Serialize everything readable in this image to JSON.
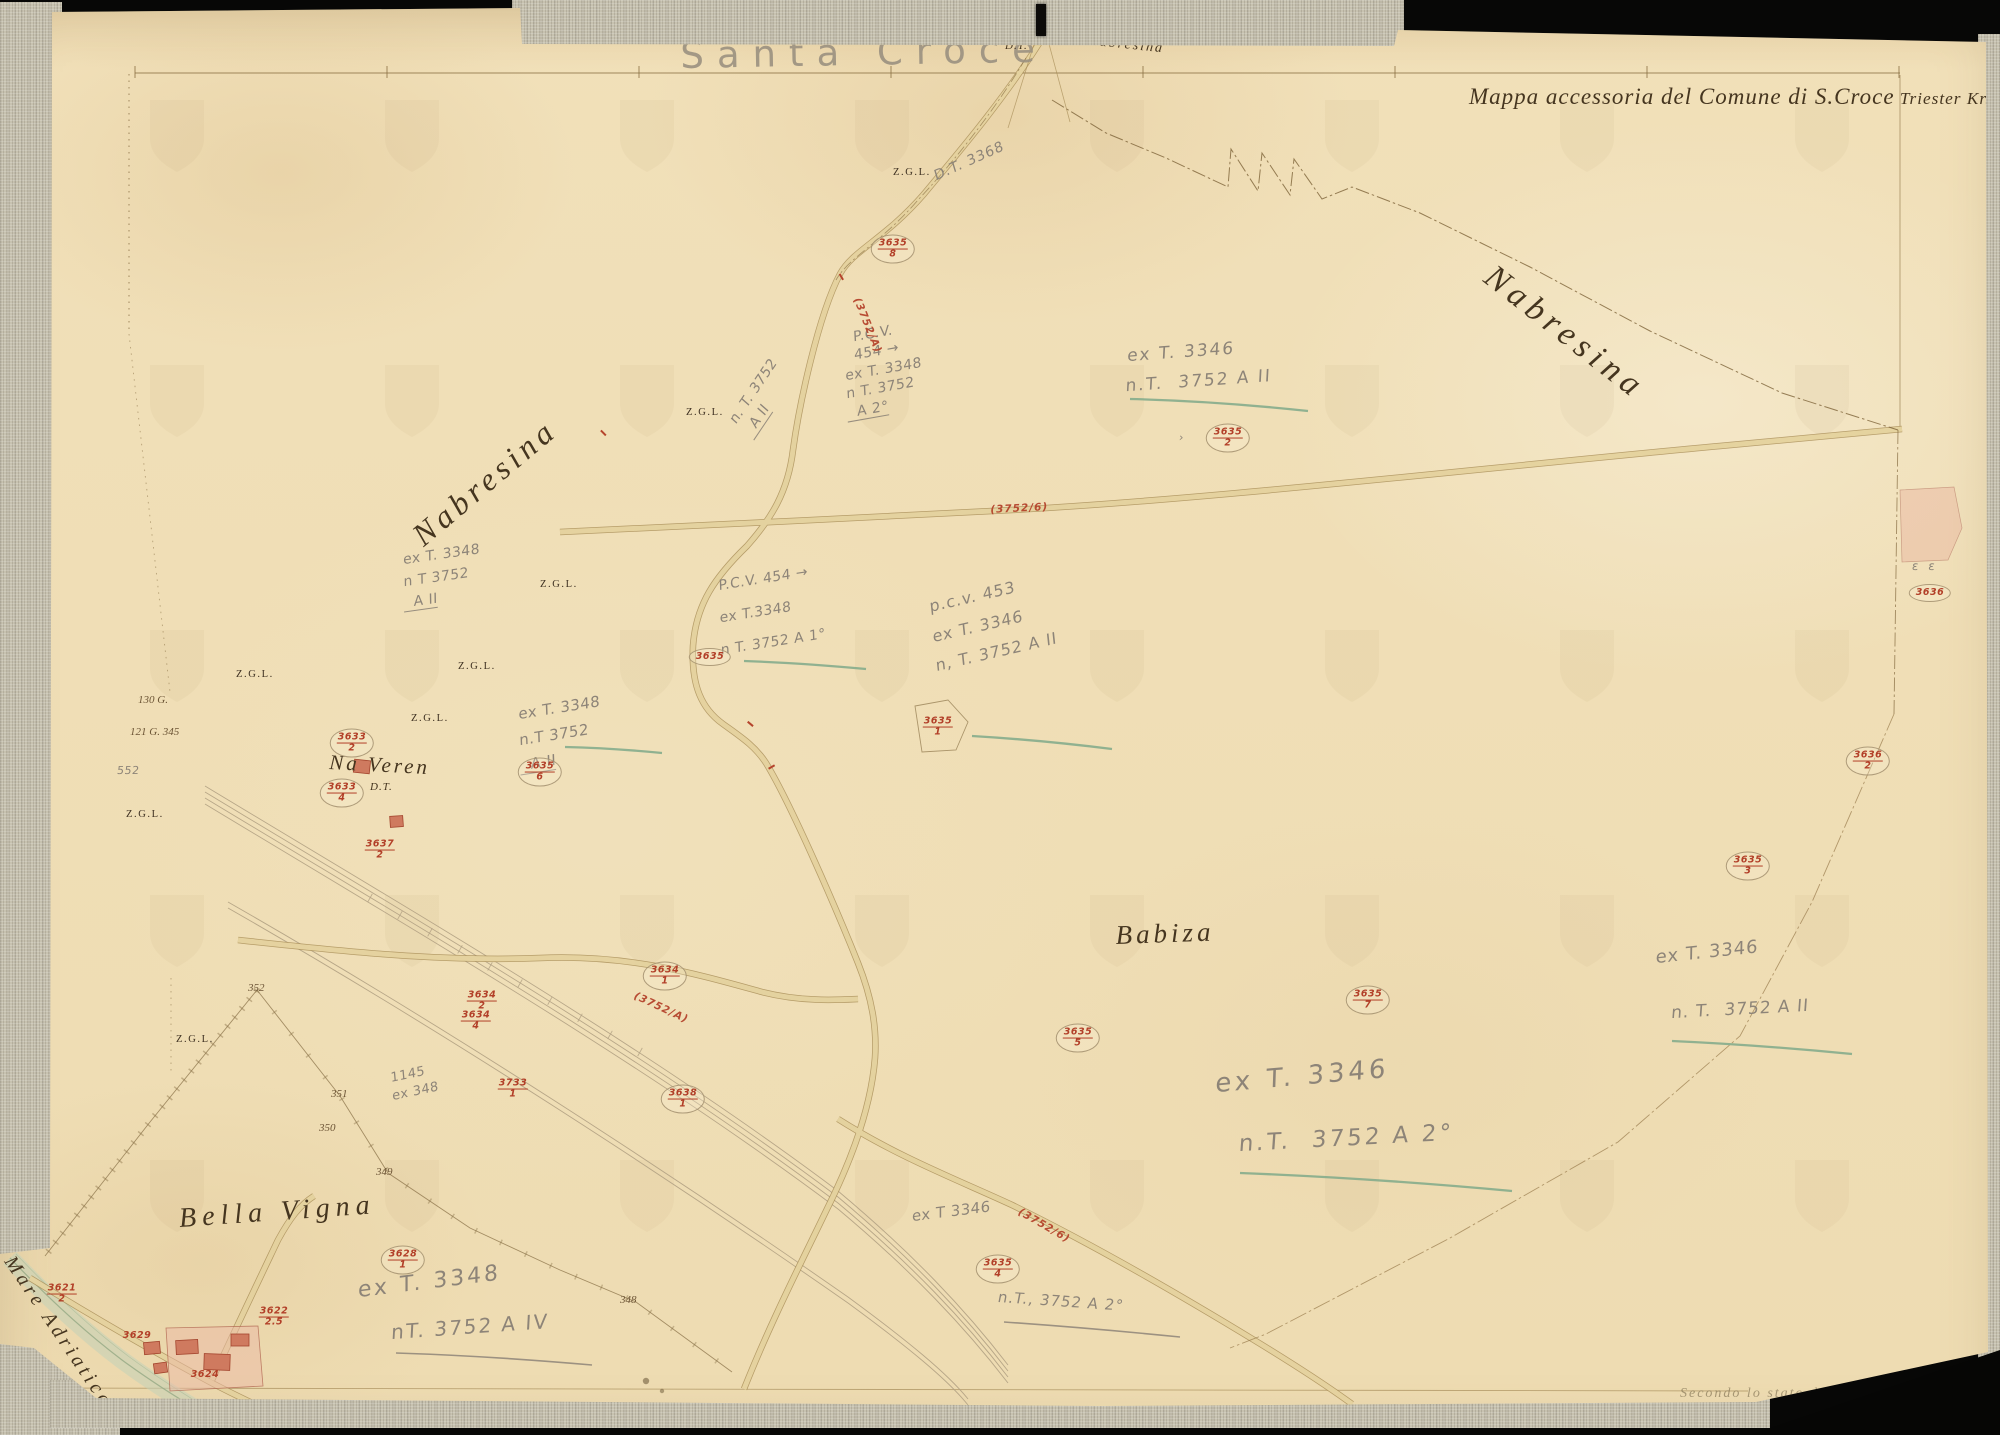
{
  "map": {
    "pencil_title": "Santa Croce",
    "header_title": "Mappa accessoria del Comune di S.Croce",
    "header_subtitle": " Triester Kr.",
    "footer_note": "Secondo lo stato dell' anno 1901"
  },
  "colors": {
    "paper": "#f1e0b9",
    "fabric": "#c7c2b0",
    "ink_engraved": "#45351f",
    "pencil": "#8d8478",
    "red_parcel": "#b23f28",
    "green_underline": "#7fa98a",
    "road_fill": "#e7d5a0",
    "road_edge": "#a78c55",
    "sea": "#c3d2b8"
  },
  "place_labels": [
    {
      "name": "place-nabresina-right",
      "text": "Nabresina",
      "x": 1500,
      "y": 258,
      "size": 34,
      "rot": 38,
      "ls": 6,
      "cls": "engraved"
    },
    {
      "name": "place-nabresina-left",
      "text": "Nabresina",
      "x": 405,
      "y": 525,
      "size": 32,
      "rot": -40,
      "ls": 5,
      "cls": "engraved"
    },
    {
      "name": "place-na-veren",
      "text": "Na Veren",
      "x": 330,
      "y": 750,
      "size": 21,
      "rot": 3,
      "ls": 3,
      "cls": "engraved"
    },
    {
      "name": "label-dt-naveren",
      "text": "D.T.",
      "x": 370,
      "y": 781,
      "size": 11,
      "rot": 0,
      "ls": 1,
      "cls": "engraved"
    },
    {
      "name": "place-babiza",
      "text": "Babiza",
      "x": 1115,
      "y": 920,
      "size": 27,
      "rot": -2,
      "ls": 4,
      "cls": "engraved"
    },
    {
      "name": "place-bella-vigna",
      "text": "Bella Vigna",
      "x": 178,
      "y": 1203,
      "size": 28,
      "rot": -4,
      "ls": 6,
      "cls": "engraved"
    },
    {
      "name": "place-mare-adriatico",
      "text": "Mare Adriatico",
      "x": 18,
      "y": 1252,
      "size": 20,
      "rot": 56,
      "ls": 4,
      "cls": "engraved"
    },
    {
      "name": "label-dt-top",
      "text": "D.T.",
      "x": 1005,
      "y": 40,
      "size": 11,
      "rot": 0,
      "ls": 1,
      "cls": "engraved"
    },
    {
      "name": "label-da-nabresina",
      "text": "da Nabresina",
      "x": 1066,
      "y": 31,
      "size": 14,
      "rot": 6,
      "ls": 2,
      "cls": "engraved"
    }
  ],
  "zgl_labels": [
    {
      "x": 893,
      "y": 167
    },
    {
      "x": 686,
      "y": 407
    },
    {
      "x": 540,
      "y": 579
    },
    {
      "x": 458,
      "y": 661
    },
    {
      "x": 411,
      "y": 713
    },
    {
      "x": 236,
      "y": 669
    },
    {
      "x": 126,
      "y": 809
    },
    {
      "x": 176,
      "y": 1034
    }
  ],
  "zgl_text": "Z.G.L.",
  "boundary_numbers": [
    {
      "t": "352",
      "x": 248,
      "y": 982
    },
    {
      "t": "351",
      "x": 331,
      "y": 1088
    },
    {
      "t": "350",
      "x": 319,
      "y": 1122
    },
    {
      "t": "349",
      "x": 376,
      "y": 1166
    },
    {
      "t": "348",
      "x": 620,
      "y": 1294
    },
    {
      "t": "130 G.",
      "x": 138,
      "y": 694
    },
    {
      "t": "121 G. 345",
      "x": 130,
      "y": 726
    }
  ],
  "pencil_blocks": [
    {
      "name": "ann-road-3752-a2",
      "x": 726,
      "y": 416,
      "rot": -56,
      "size": 14,
      "lh": 1.35,
      "lines": [
        {
          "t": "n. T. 3752"
        },
        {
          "t": "  A II",
          "u": true
        }
      ]
    },
    {
      "name": "ann-pcv454-upper",
      "x": 843,
      "y": 330,
      "rot": -10,
      "size": 14,
      "lh": 1.32,
      "lines": [
        {
          "t": "  P.C.V."
        },
        {
          "t": "  454 →"
        },
        {
          "t": "ex T. 3348"
        },
        {
          "t": "n T. 3752"
        },
        {
          "t": "  A 2°",
          "u": true
        }
      ]
    },
    {
      "name": "ann-ext3346-upper",
      "x": 1128,
      "y": 342,
      "rot": -4,
      "size": 17,
      "lh": 1.75,
      "ls": 2,
      "lines": [
        {
          "t": "ex T. 3346"
        },
        {
          "t": "n.T.  3752 A II"
        }
      ]
    },
    {
      "name": "ann-dt3368",
      "x": 932,
      "y": 168,
      "rot": -24,
      "size": 14,
      "ls": 1,
      "lines": [
        {
          "t": "D.T. 3368"
        }
      ]
    },
    {
      "name": "ann-pcv454-mid",
      "x": 718,
      "y": 570,
      "rot": -9,
      "size": 14,
      "lh": 2.3,
      "lines": [
        {
          "t": "P.C.V. 454 →"
        },
        {
          "t": "ex T.3348"
        },
        {
          "t": "n T. 3752 A 1°"
        }
      ]
    },
    {
      "name": "ann-pcv453",
      "x": 928,
      "y": 592,
      "rot": -13,
      "size": 16,
      "lh": 1.85,
      "ls": 1,
      "lines": [
        {
          "t": "p.c.v. 453"
        },
        {
          "t": ""
        },
        {
          "t": "ex T. 3346"
        },
        {
          "t": ""
        },
        {
          "t": "n, T. 3752 A II"
        }
      ]
    },
    {
      "name": "ann-naveren-cluster",
      "x": 518,
      "y": 702,
      "rot": -9,
      "size": 15,
      "lh": 1.7,
      "lines": [
        {
          "t": "ex T. 3348"
        },
        {
          "t": "n.T 3752"
        },
        {
          "t": "  A II",
          "u": true
        }
      ]
    },
    {
      "name": "ann-left-cluster",
      "x": 403,
      "y": 550,
      "rot": -8,
      "size": 14,
      "lh": 1.55,
      "lines": [
        {
          "t": "ex T. 3348"
        },
        {
          "t": "n T 3752"
        },
        {
          "t": "  A II",
          "u": true
        }
      ]
    },
    {
      "name": "ann-arrow-mark",
      "x": 1180,
      "y": 430,
      "rot": 0,
      "size": 11,
      "lines": [
        {
          "t": "›"
        }
      ]
    },
    {
      "name": "ann-right-ex3346",
      "x": 1656,
      "y": 945,
      "rot": -6,
      "size": 18,
      "ls": 1,
      "lines": [
        {
          "t": "ex T. 3346"
        }
      ]
    },
    {
      "name": "ann-right-nt3752",
      "x": 1672,
      "y": 1002,
      "rot": -3,
      "size": 17,
      "ls": 1,
      "lines": [
        {
          "t": "n. T.  3752 A II"
        }
      ]
    },
    {
      "name": "ann-big-ex3346",
      "x": 1216,
      "y": 1066,
      "rot": -5,
      "size": 26,
      "ls": 4,
      "lines": [
        {
          "t": "ex T. 3346"
        }
      ]
    },
    {
      "name": "ann-big-nt3752",
      "x": 1240,
      "y": 1128,
      "rot": -3,
      "size": 23,
      "ls": 3,
      "lines": [
        {
          "t": "n.T.  3752 A 2°"
        }
      ]
    },
    {
      "name": "ann-mid-ex3346",
      "x": 912,
      "y": 1206,
      "rot": -7,
      "size": 15,
      "lines": [
        {
          "t": "ex T 3346"
        }
      ]
    },
    {
      "name": "ann-mid-nt3752",
      "x": 1000,
      "y": 1287,
      "rot": 4,
      "size": 15,
      "ls": 1,
      "lines": [
        {
          "t": "n.T., 3752 A 2°"
        }
      ]
    },
    {
      "name": "ann-bl-ex3348",
      "x": 358,
      "y": 1276,
      "rot": -7,
      "size": 22,
      "ls": 3,
      "lines": [
        {
          "t": "ex T. 3348"
        }
      ]
    },
    {
      "name": "ann-bl-nt3752",
      "x": 392,
      "y": 1318,
      "rot": -4,
      "size": 20,
      "ls": 2,
      "lines": [
        {
          "t": "nT. 3752 A IV"
        }
      ]
    },
    {
      "name": "ann-1145",
      "x": 390,
      "y": 1070,
      "rot": -12,
      "size": 13,
      "lh": 1.4,
      "lines": [
        {
          "t": "1145"
        },
        {
          "t": "ex 348"
        }
      ]
    },
    {
      "name": "ann-552",
      "x": 118,
      "y": 763,
      "rot": 0,
      "size": 11,
      "lines": [
        {
          "t": "552"
        }
      ]
    },
    {
      "name": "ann-epsilon",
      "x": 1913,
      "y": 558,
      "rot": 0,
      "size": 12,
      "ls": 3,
      "lines": [
        {
          "t": "ε ε"
        }
      ]
    }
  ],
  "red_parcels": [
    {
      "x": 893,
      "y": 249,
      "t": "3635",
      "b": "8",
      "c": true
    },
    {
      "x": 1228,
      "y": 438,
      "t": "3635",
      "b": "2",
      "c": true
    },
    {
      "x": 710,
      "y": 657,
      "t": "3635",
      "b": "",
      "c": true
    },
    {
      "x": 938,
      "y": 727,
      "t": "3635",
      "b": "1",
      "c": false
    },
    {
      "x": 540,
      "y": 772,
      "t": "3635",
      "b": "6",
      "c": true
    },
    {
      "x": 1868,
      "y": 761,
      "t": "3636",
      "b": "2",
      "c": true
    },
    {
      "x": 1748,
      "y": 866,
      "t": "3635",
      "b": "3",
      "c": true
    },
    {
      "x": 1368,
      "y": 1000,
      "t": "3635",
      "b": "7",
      "c": true
    },
    {
      "x": 1078,
      "y": 1038,
      "t": "3635",
      "b": "5",
      "c": true
    },
    {
      "x": 665,
      "y": 976,
      "t": "3634",
      "b": "1",
      "c": true
    },
    {
      "x": 482,
      "y": 1001,
      "t": "3634",
      "b": "2",
      "c": false
    },
    {
      "x": 476,
      "y": 1021,
      "t": "3634",
      "b": "4",
      "c": false
    },
    {
      "x": 513,
      "y": 1089,
      "t": "3733",
      "b": "1",
      "c": false
    },
    {
      "x": 683,
      "y": 1099,
      "t": "3638",
      "b": "1",
      "c": true
    },
    {
      "x": 998,
      "y": 1269,
      "t": "3635",
      "b": "4",
      "c": true
    },
    {
      "x": 403,
      "y": 1260,
      "t": "3628",
      "b": "1",
      "c": true
    },
    {
      "x": 62,
      "y": 1294,
      "t": "3621",
      "b": "2",
      "c": false
    },
    {
      "x": 137,
      "y": 1336,
      "t": "3629",
      "b": "",
      "c": false
    },
    {
      "x": 274,
      "y": 1317,
      "t": "3622",
      "b": "2.5",
      "c": false
    },
    {
      "x": 205,
      "y": 1375,
      "t": "3624",
      "b": "",
      "c": false
    },
    {
      "x": 352,
      "y": 743,
      "t": "3633",
      "b": "2",
      "c": true
    },
    {
      "x": 342,
      "y": 793,
      "t": "3633",
      "b": "4",
      "c": true
    },
    {
      "x": 380,
      "y": 850,
      "t": "3637",
      "b": "2",
      "c": false
    },
    {
      "x": 1930,
      "y": 593,
      "t": "3636",
      "b": "",
      "c": true
    }
  ],
  "road_labels_red": [
    {
      "t": "(3752/A)",
      "x": 862,
      "y": 296,
      "rot": 68
    },
    {
      "t": "(3752/6)",
      "x": 990,
      "y": 504,
      "rot": -3
    },
    {
      "t": "(3752/A)",
      "x": 637,
      "y": 990,
      "rot": 25
    },
    {
      "t": "(3752/6)",
      "x": 1022,
      "y": 1206,
      "rot": 30
    }
  ],
  "red_ticks": [
    {
      "x": 747,
      "y": 723,
      "rot": 40
    },
    {
      "x": 768,
      "y": 766,
      "rot": -30
    },
    {
      "x": 838,
      "y": 276,
      "rot": 60
    },
    {
      "x": 600,
      "y": 432,
      "rot": 45
    }
  ]
}
